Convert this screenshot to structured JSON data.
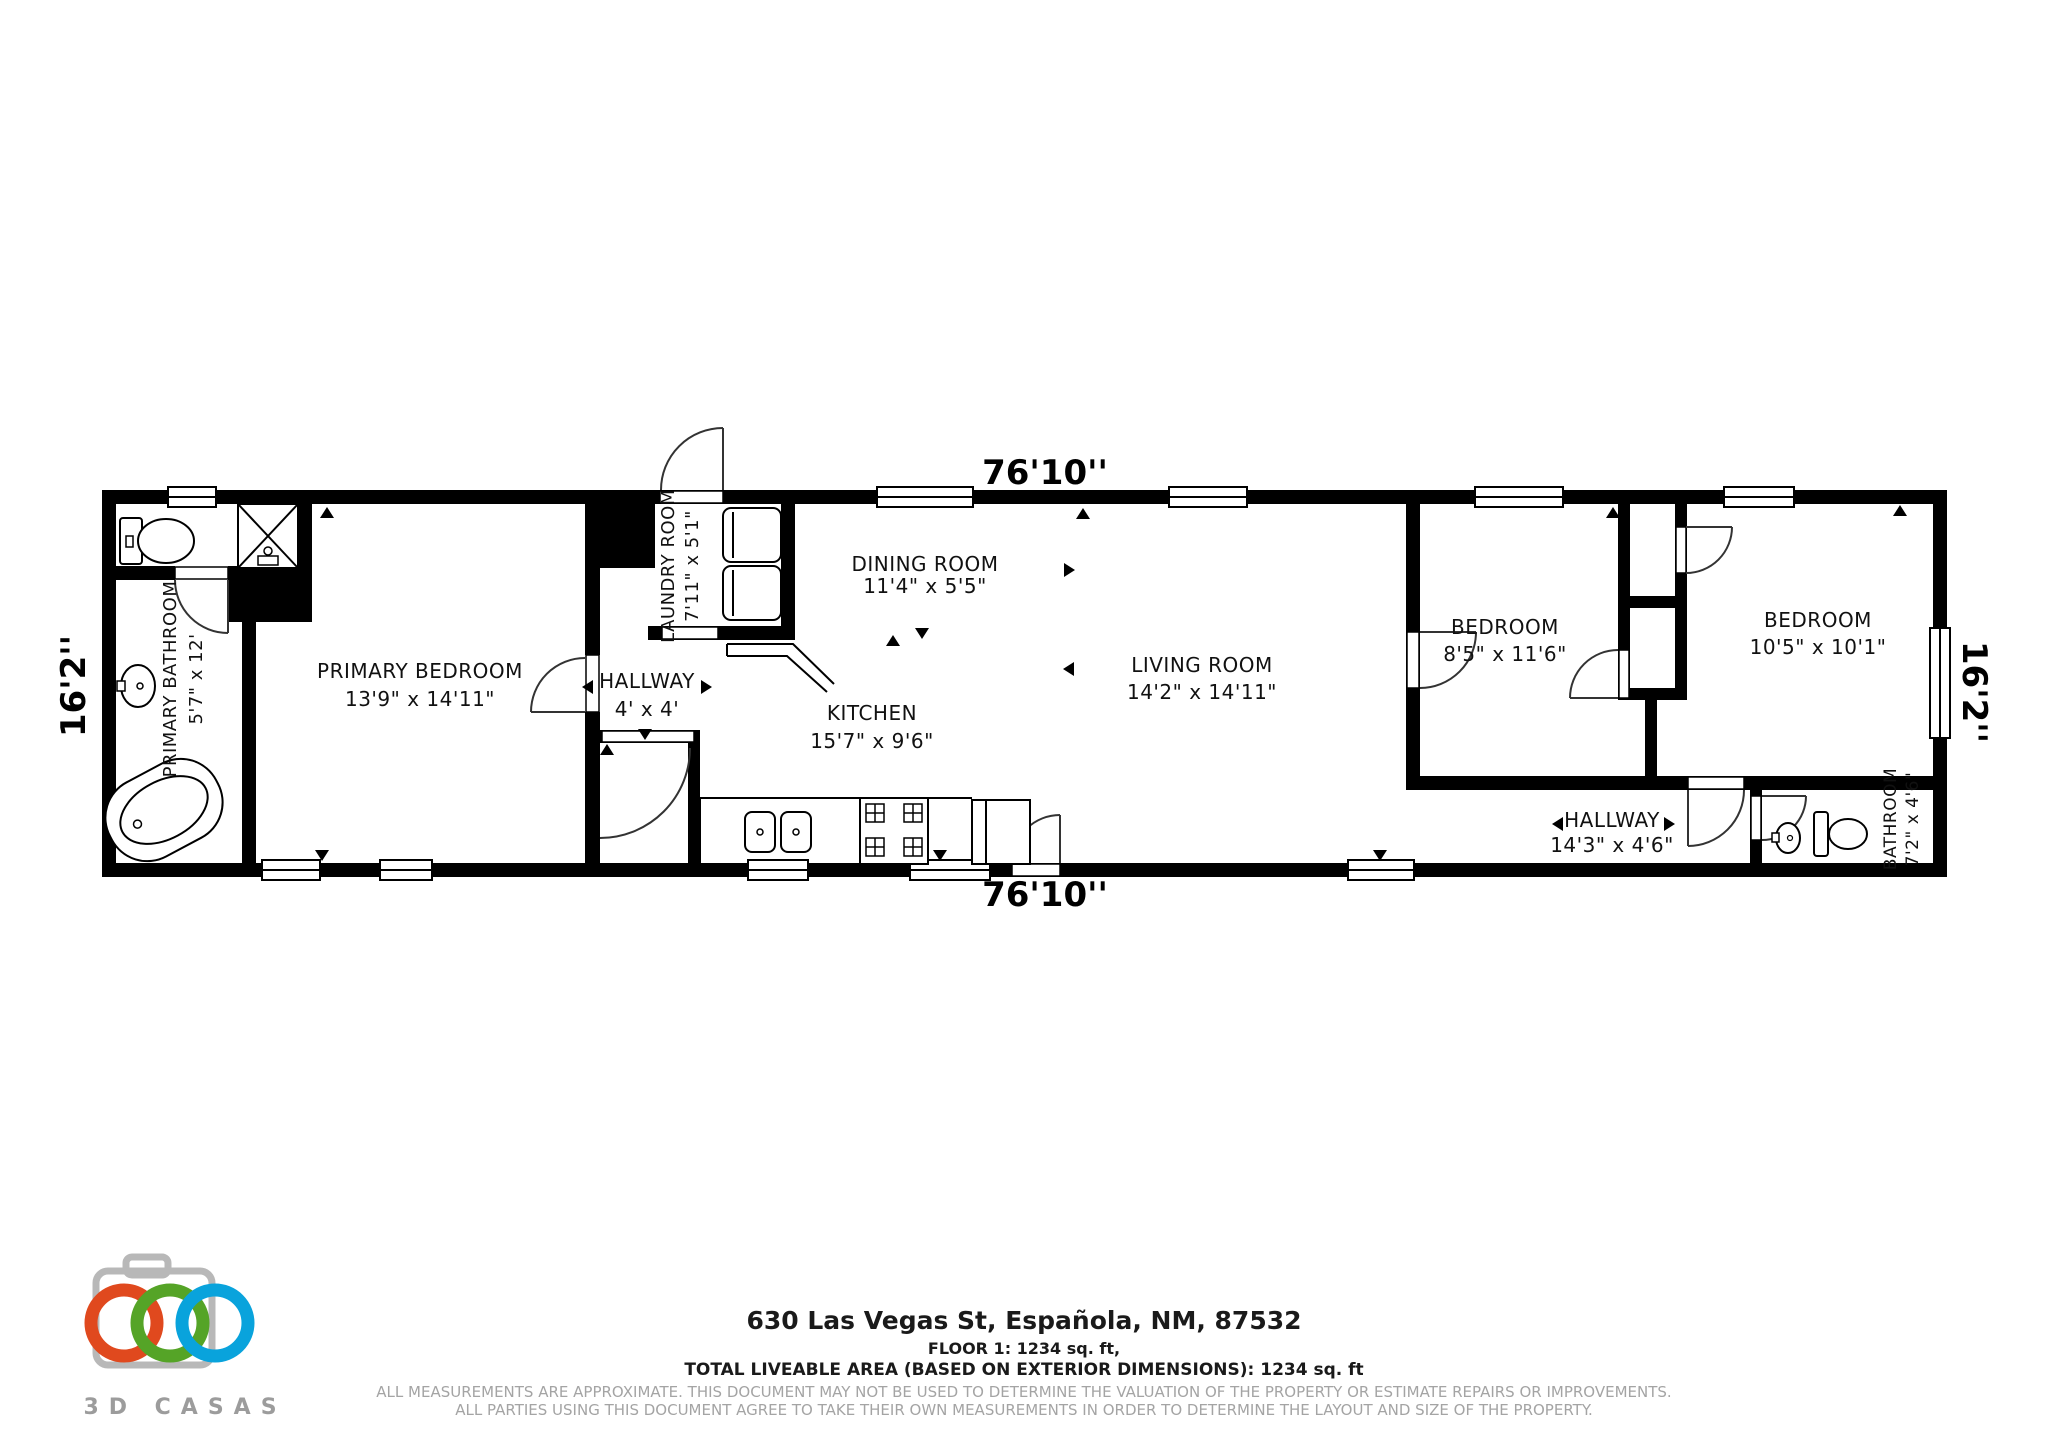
{
  "plan": {
    "dimensions": {
      "top": "76'10''",
      "bottom": "76'10''",
      "left": "16'2''",
      "right": "16'2''"
    },
    "rooms": {
      "primary_bathroom": {
        "name": "PRIMARY BATHROOM",
        "dims": "5'7\" x 12'"
      },
      "primary_bedroom": {
        "name": "PRIMARY BEDROOM",
        "dims": "13'9\" x 14'11\""
      },
      "hallway1": {
        "name": "HALLWAY",
        "dims": "4' x 4'"
      },
      "laundry": {
        "name": "LAUNDRY ROOM",
        "dims": "7'11\" x 5'1\""
      },
      "kitchen": {
        "name": "KITCHEN",
        "dims": "15'7\" x 9'6\""
      },
      "dining": {
        "name": "DINING ROOM",
        "dims": "11'4\" x 5'5\""
      },
      "living": {
        "name": "LIVING ROOM",
        "dims": "14'2\" x 14'11\""
      },
      "bedroom1": {
        "name": "BEDROOM",
        "dims": "8'5\" x 11'6\""
      },
      "bedroom2": {
        "name": "BEDROOM",
        "dims": "10'5\" x 10'1\""
      },
      "hallway2": {
        "name": "HALLWAY",
        "dims": "14'3\" x 4'6\""
      },
      "bathroom2": {
        "name": "BATHROOM",
        "dims": "7'2\" x 4'6\""
      }
    }
  },
  "footer": {
    "logo_text": "3D CASAS",
    "address": "630 Las Vegas St, Española, NM, 87532",
    "floor_line": "FLOOR 1: 1234 sq. ft,",
    "total_line": "TOTAL LIVEABLE AREA (BASED ON EXTERIOR DIMENSIONS): 1234 sq. ft",
    "disclaimer1": "ALL MEASUREMENTS ARE APPROXIMATE. THIS DOCUMENT MAY NOT BE USED TO DETERMINE THE VALUATION OF THE PROPERTY OR ESTIMATE REPAIRS OR IMPROVEMENTS.",
    "disclaimer2": "ALL PARTIES USING THIS DOCUMENT AGREE TO TAKE THEIR OWN MEASUREMENTS IN ORDER TO DETERMINE THE LAYOUT AND SIZE OF THE PROPERTY."
  },
  "colors": {
    "wall": "#000000",
    "logo_red": "#e0491e",
    "logo_green": "#55a427",
    "logo_blue": "#09a3dc",
    "logo_gray": "#b8b8b8",
    "disclaimer_gray": "#a4a4a4"
  }
}
